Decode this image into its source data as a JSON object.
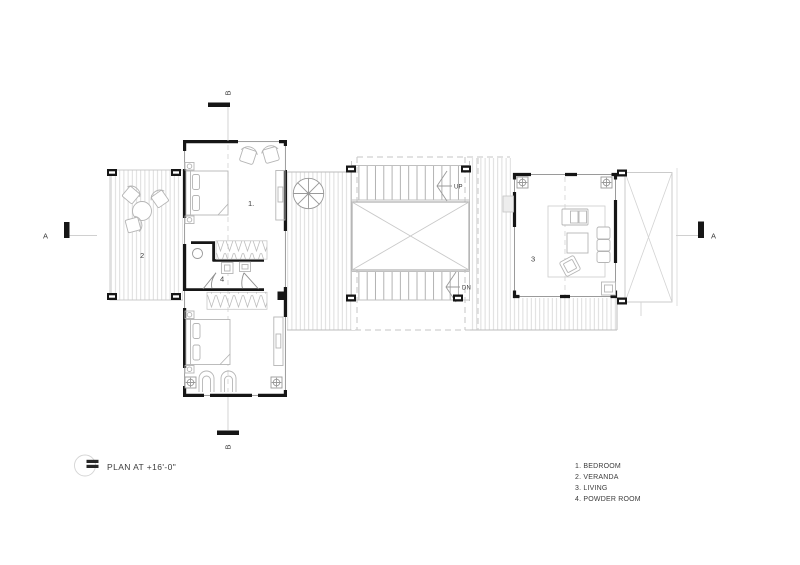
{
  "plan": {
    "title": "PLAN AT +16'-0\"",
    "room_labels": {
      "bedroom_upper": "1.",
      "veranda": "2",
      "living": "3",
      "powder_room": "4"
    },
    "stair_labels": {
      "up": "UP",
      "down": "DN"
    },
    "section_markers": {
      "a_left": "A",
      "a_right": "A",
      "b_top": "B",
      "b_bottom": "B"
    },
    "legend": [
      "1. BEDROOM",
      "2. VERANDA",
      "3. LIVING",
      "4. POWDER ROOM"
    ],
    "colors": {
      "background": "#ffffff",
      "wall": "#161616",
      "window_line": "#8f8f8f",
      "deck_line": "#d4d4d4",
      "edge_line": "#bdbdbd",
      "dashed_roof_line": "#c6c6c6",
      "furniture_line": "#b5b5b5",
      "text": "#3c3c3c"
    }
  }
}
